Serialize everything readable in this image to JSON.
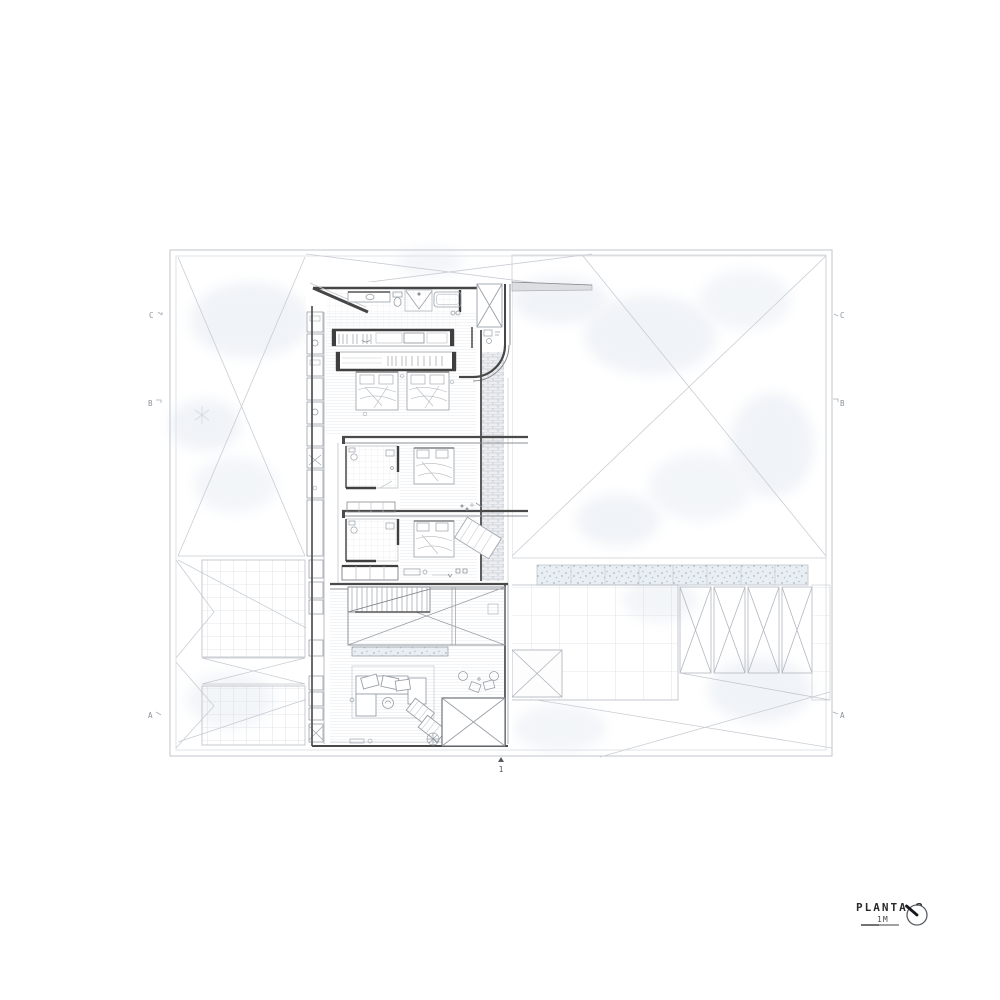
{
  "title_block": {
    "title": "PLANTA 2",
    "scale_label": "1M"
  },
  "section_markers": {
    "left": [
      "C",
      "B",
      "A"
    ],
    "right": [
      "C",
      "B",
      "A"
    ],
    "bottom": [
      "1"
    ]
  },
  "icons": {
    "north": "compass-needle-icon"
  },
  "colors": {
    "paper": "#ffffff",
    "wall_dark": "#464646",
    "line_light": "#c9cdd3",
    "line_mid": "#9aa0a8",
    "wash": "#e4eaf2",
    "text_dark": "#2b2b2b",
    "text_grey": "#8d939a"
  }
}
